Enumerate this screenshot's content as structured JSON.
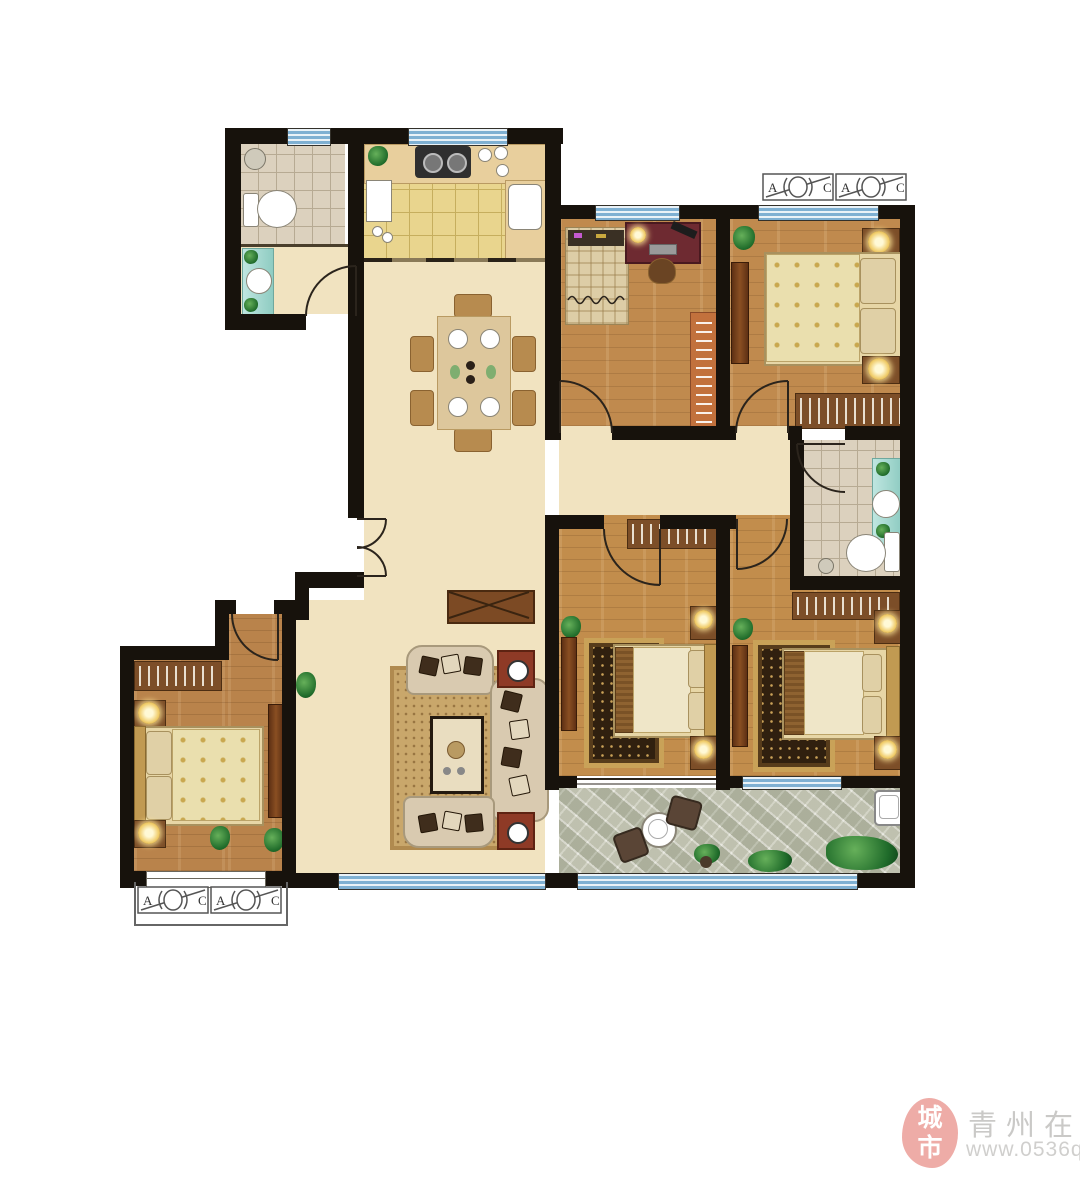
{
  "watermark": {
    "seal_top": "城",
    "seal_bottom": "市",
    "site_name": "青州在线",
    "site_url": "www.0536qz.com"
  },
  "ac": {
    "letter_a": "A",
    "letter_c": "C"
  },
  "palette": {
    "wall": "#17120c",
    "hall_tile": "#f1e3c0",
    "hall_tile_lines": "#d3bd92",
    "kitchen_tile": "#e9d58e",
    "bath_tile": "#dcd1be",
    "wood_floor": "#c08a4e",
    "balcony_stone": "#d6d6c8",
    "window_blue": "#7fb0d2",
    "counter_wood": "#e8cf9d",
    "vanity_teal": "#9cd4cb",
    "desk_maroon": "#6e2a31",
    "bookshelf_orange": "#c2713d",
    "sofa_cream": "#d9cab0",
    "living_rug": "#c9a76b",
    "bedroom_rug_dark": "#30200f",
    "bedroom_rug_gold": "#c9a258",
    "side_table_red": "#8e3a26",
    "seal_pink": "#ec9e98",
    "watermark_gray": "#c1c0be"
  },
  "plan": {
    "rooms": [
      "bathroom-top-left",
      "kitchen",
      "study-bedroom",
      "bedroom-top-right",
      "hallway-dining",
      "corridor",
      "bathroom-right",
      "living-room",
      "bedroom-middle",
      "bedroom-bottom-right",
      "bedroom-bottom-left",
      "balcony",
      "entry"
    ]
  }
}
